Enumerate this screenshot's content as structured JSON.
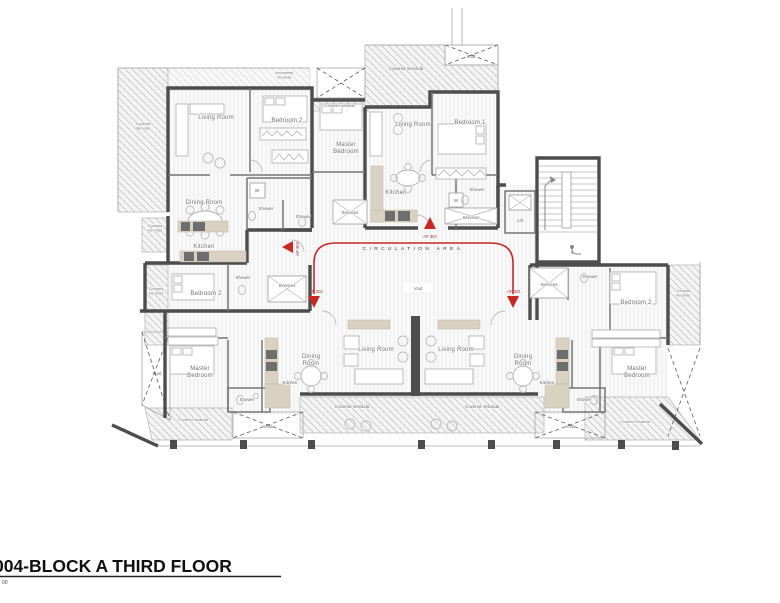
{
  "colors": {
    "accent_red": "#c62828",
    "wall_gray": "#4d4d4d",
    "counter_tan": "#d9d1c2"
  },
  "title": {
    "name": "004-BLOCK A THIRD FLOOR",
    "scale": "00"
  },
  "circulation": {
    "area_label": "CIRCULATION AREA"
  },
  "apartments": {
    "ap301": "AP 301",
    "ap302": "AP 302",
    "ap303": "AP 303",
    "ap304": "AP 304"
  },
  "rooms": {
    "living1": "Living Room",
    "living2": "Living Room",
    "living3": "Living Room",
    "living4": "Living Room",
    "bedroom1": "Bedroom 1",
    "bedroom2a": "Bedroom 2",
    "bedroom2b": "Bedroom 2",
    "bedroom2c": "Bedroom 2",
    "master1": "Master\nBedroom",
    "master2": "Master\nBedroom",
    "master3": "Master\nBedroom",
    "dining1": "Dining Room",
    "dining2": "Dining\nRoom",
    "dining3": "Dining\nRoom",
    "kitchen1": "Kitchen",
    "kitchen2": "Kitchen",
    "kitchen3": "Kitchen",
    "kitchen4": "Kitchen",
    "shower1": "Shower",
    "shower2": "Shower",
    "shower3": "Shower",
    "shower4": "Shower",
    "shower5": "Shower",
    "shower6": "Shower",
    "shower7": "Shower",
    "services1": "Services",
    "services2": "Services",
    "services3": "Services",
    "services4": "Services",
    "w1": "W",
    "w2": "W",
    "lift": "Lift"
  },
  "verandas": {
    "covered_left": "Covered\nVeranda",
    "uncovered_top": "Uncovered\nVeranda",
    "covered_small_top": "Covered Veranda",
    "covered_mid_top": "Covered Veranda",
    "covered_left_mid": "Covered\nVeranda",
    "covered_left_strip": "Covered\nVeranda",
    "covered_bottom_left": "Covered Veranda",
    "covered_bottom_center_left": "Covered Veranda",
    "covered_bottom_center_right": "Covered Veranda",
    "covered_bottom_right": "Covered Veranda",
    "covered_right_strip": "Covered\nVeranda"
  },
  "voids": {
    "top": "Void",
    "center": "Void",
    "left": "Void",
    "bottom_left": "Void",
    "bottom_right": "Void"
  }
}
